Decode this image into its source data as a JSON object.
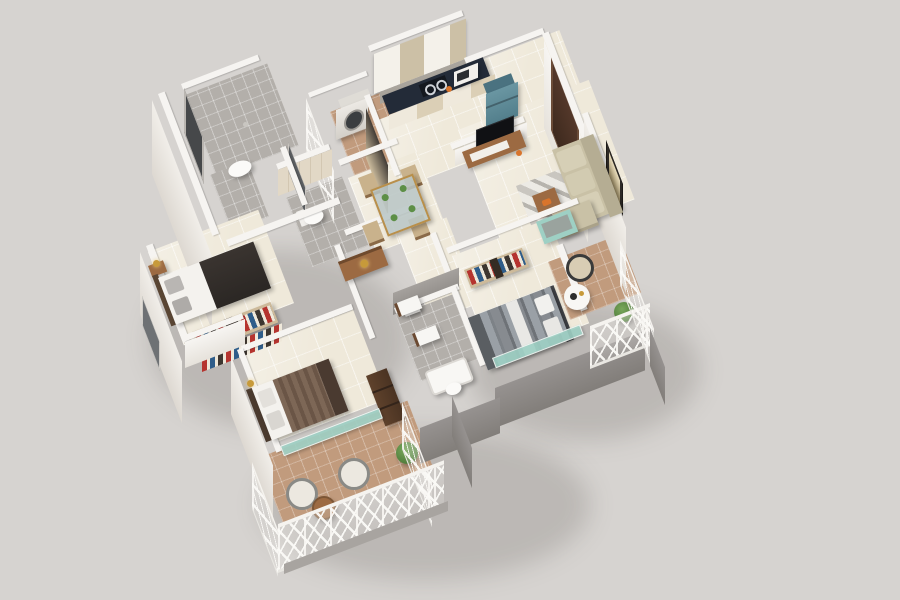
{
  "meta": {
    "description": "3D isometric render of a 3 BHK apartment floor plan: kitchen with navy counter, teal fridge and utility balcony with washing machine; living room with beige L-sofa, rug, TV unit and entrance door; dining table for four; two gray-tiled bathrooms and a powder room; three bedrooms with dark, gray-striped and brown-striped beds plus open wardrobes; teal glass partitions and two lattice-railing balconies with wicker chairs and plants on a plain gray background"
  },
  "palette": {
    "bg": "#d6d3d0",
    "wall": "#f6f4f1",
    "floorCream": "#efe9da",
    "floorGray": "#b3afaa",
    "terracotta": "#c19b7d",
    "glassTeal": "#9ed0c4",
    "counter": "#232b38",
    "woodMid": "#9c6a42",
    "woodDark": "#553a28",
    "sofa": "#c9c1a6",
    "fridge": "#5d8b98",
    "bedDark": "#322d29",
    "gold": "#c79a3a",
    "red": "#b5342f",
    "blue": "#2f5d8a",
    "green": "#5d8f46",
    "door": "#4b3226",
    "windowDark": "#46484a",
    "grayWall": "#8f8b87"
  },
  "scene": {
    "rooms": [
      "kitchen",
      "utility-balcony",
      "entrance-foyer",
      "living-room",
      "dining",
      "main-bathroom",
      "powder-room",
      "master-bathroom",
      "bedroom-left",
      "bedroom-bottom",
      "master-bedroom",
      "balcony-right",
      "balcony-bottom"
    ],
    "objects": [
      "washing-machine",
      "microwave",
      "gas-stove",
      "refrigerator",
      "tv-unit",
      "tv-screen",
      "sofa",
      "rug",
      "coffee-table",
      "teal-bench",
      "picture-frame",
      "entrance-door",
      "dining-table",
      "dining-chairs",
      "toilet",
      "wash-basin",
      "bathtub",
      "beds",
      "open-wardrobes",
      "nightstand-lamps",
      "wicker-chairs",
      "patio-tables",
      "plants",
      "lattice-railings",
      "glass-partitions"
    ]
  }
}
